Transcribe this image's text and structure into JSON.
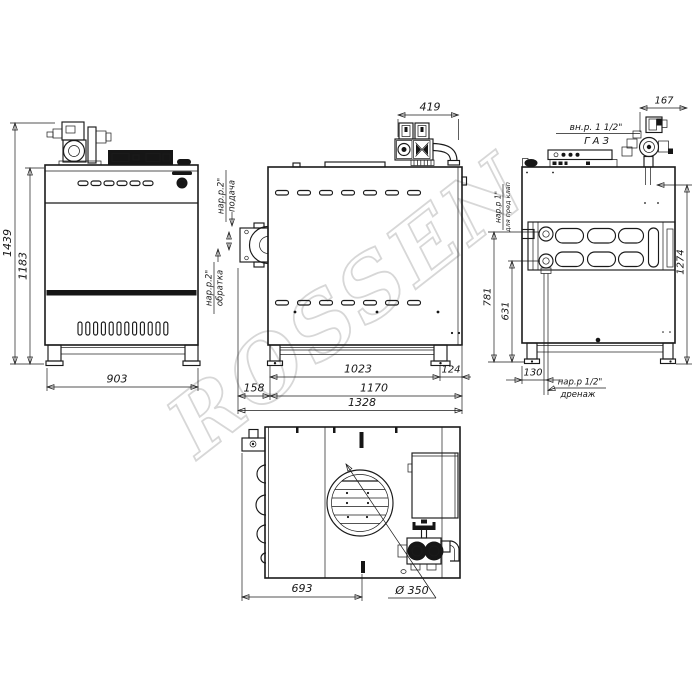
{
  "watermark": "ROSSEN",
  "front_view": {
    "dim_total_height": "1439",
    "dim_body_height": "1183",
    "dim_width": "903",
    "logo": "S"
  },
  "side_view": {
    "dim_valve": "419",
    "label_supply_size": "нар.р.2\"",
    "label_supply": "подача",
    "label_return_size": "нар.р.2\"",
    "label_return": "обратка",
    "dim_feet": "1023",
    "dim_right": "124",
    "dim_left": "158",
    "dim_feet_outer": "1170",
    "dim_total": "1328"
  },
  "rear_view": {
    "dim_gas": "167",
    "label_gas_size": "вн.р. 1 1/2\"",
    "label_gas": "ГАЗ",
    "dim_height": "1274",
    "label_safety_size": "нар.р 1\"",
    "label_safety": "для пред клап",
    "dim_safety": "781",
    "dim_lower_port": "631",
    "dim_drain": "130",
    "label_drain_size": "нар.р 1/2\"",
    "label_drain": "дренаж"
  },
  "top_view": {
    "dim_flue_offset": "693",
    "dim_flue_diameter": "Ø 350"
  }
}
